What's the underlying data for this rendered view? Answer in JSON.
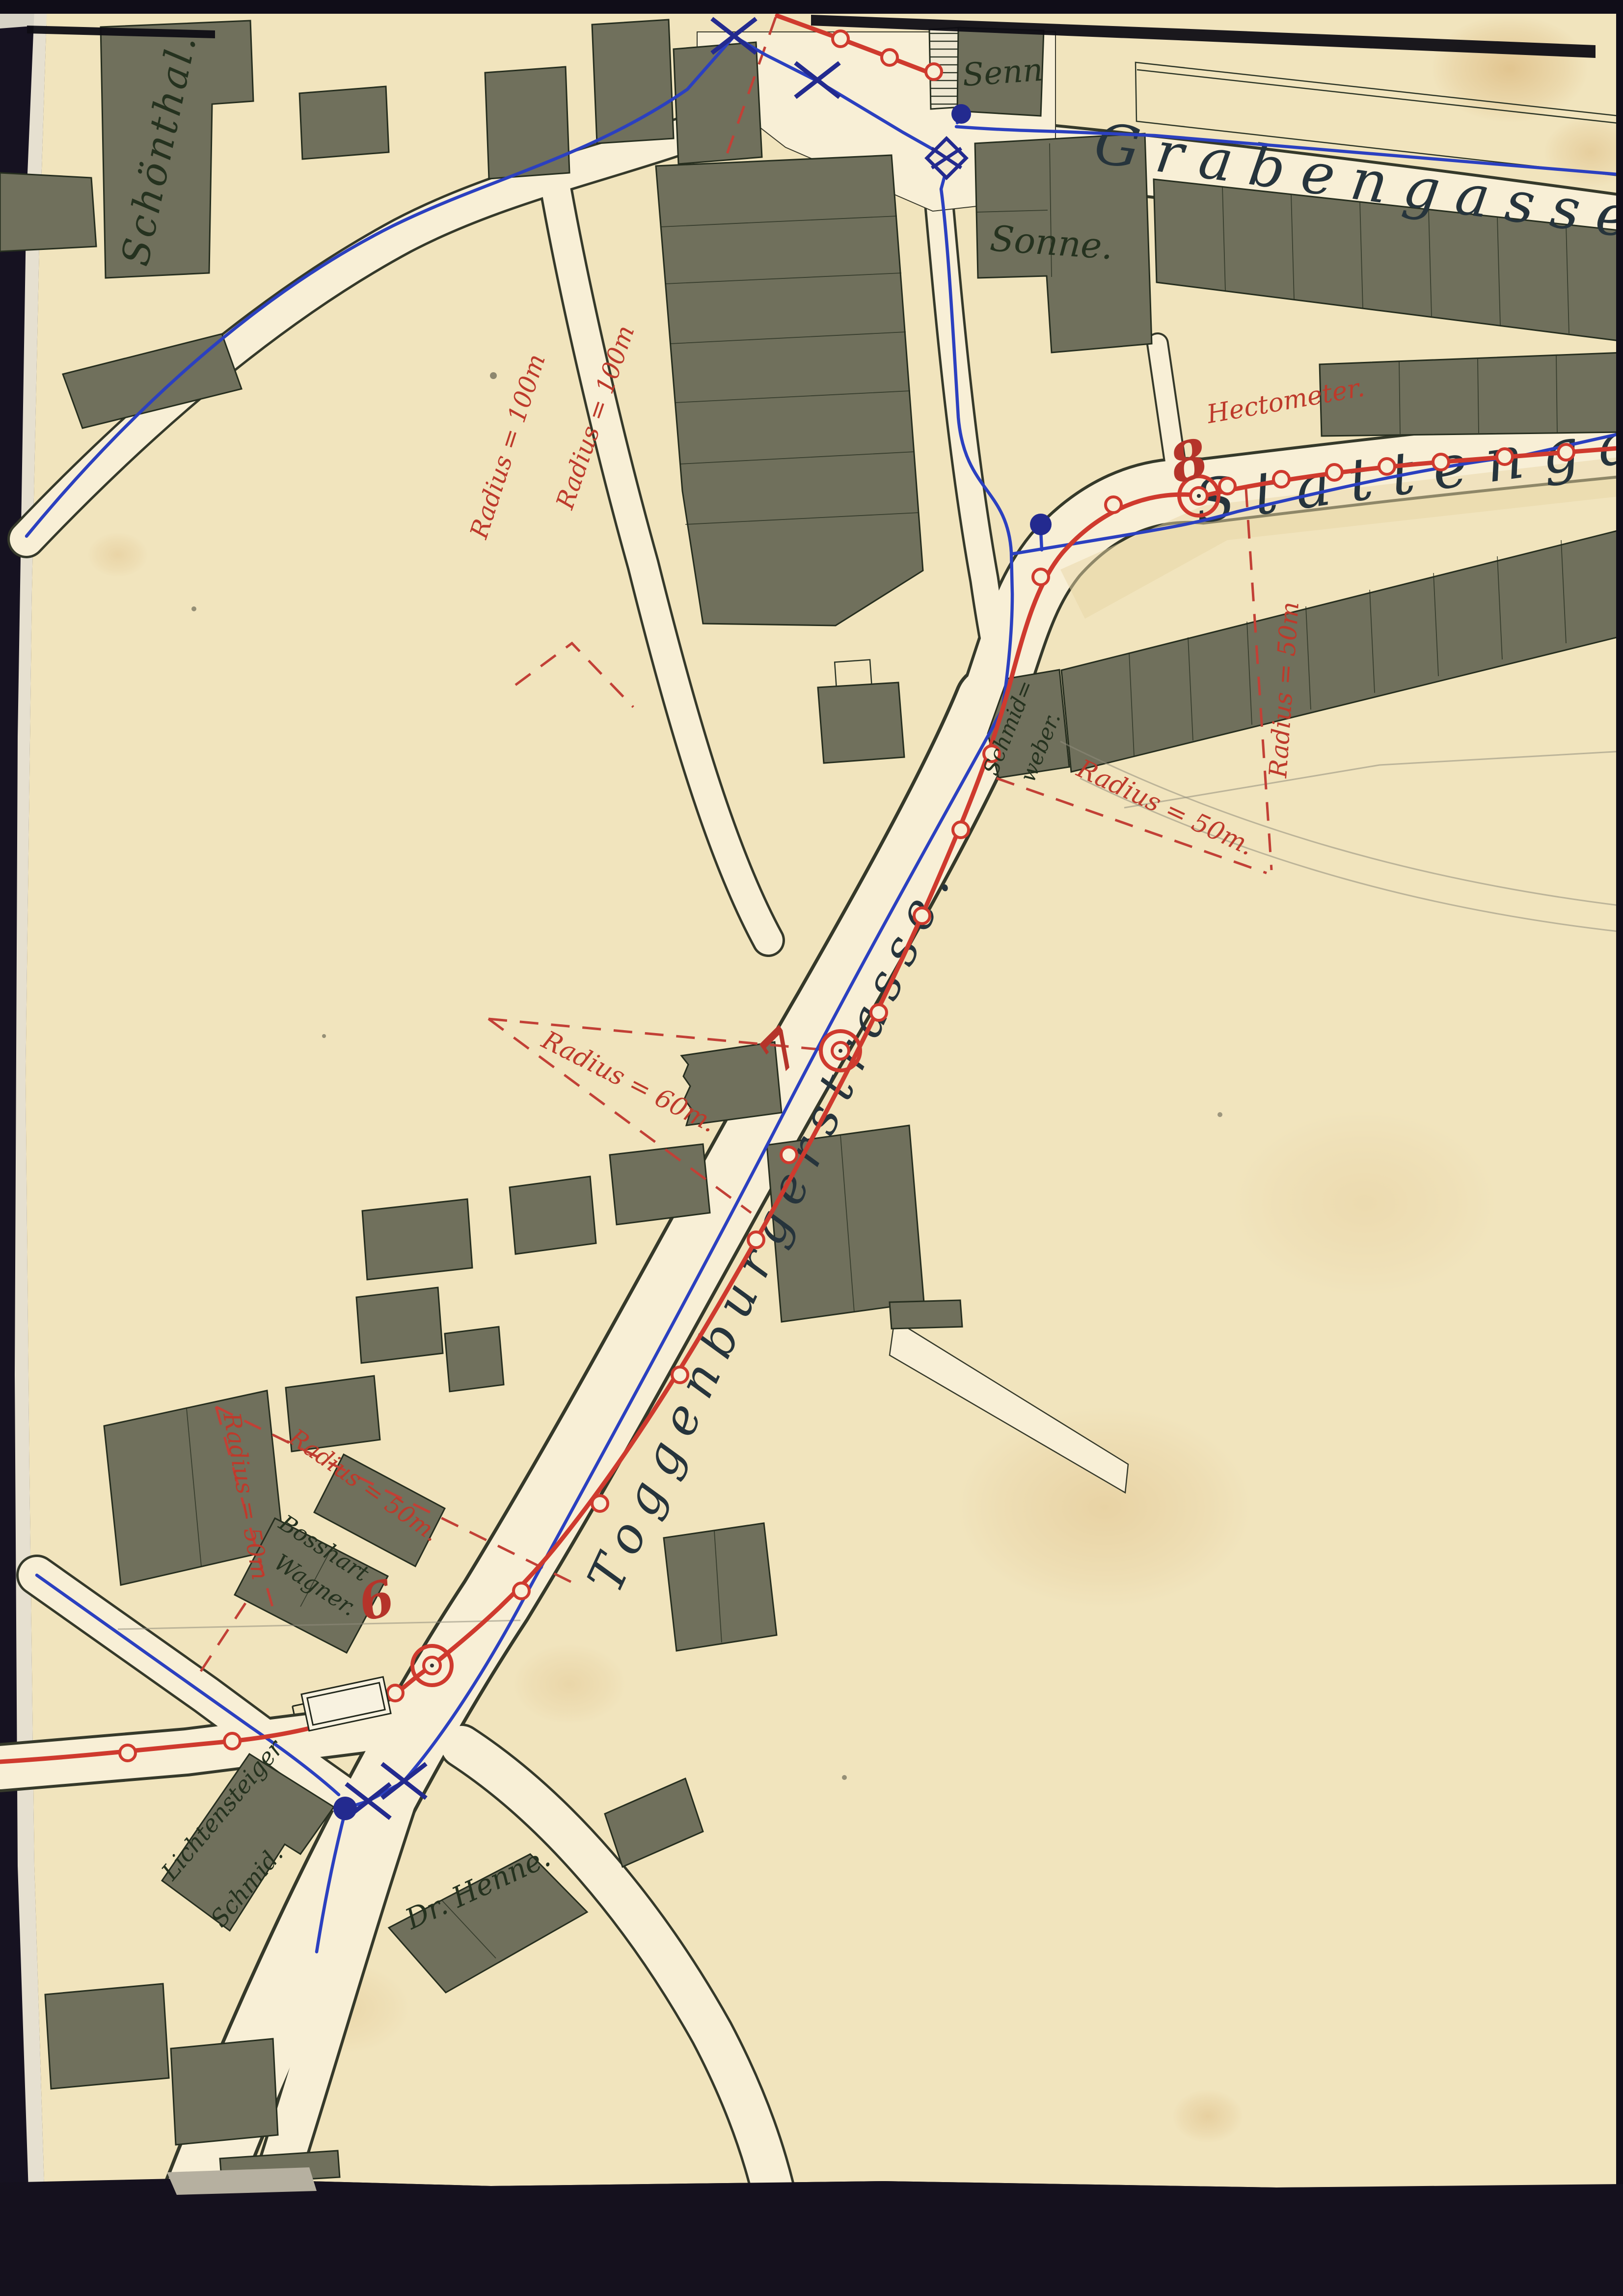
{
  "map": {
    "streets": {
      "grabengasse": "Grabengasse",
      "stattengasse": "Stattengasse",
      "toggenburgerstrasse": "Toggenburgerstrasse."
    },
    "places": {
      "schoenthal": "Schönthal.",
      "senn": "Senn",
      "sonne": "Sonne.",
      "schmid_weber_1": "Schmid=",
      "schmid_weber_2": "weber.",
      "bosshart": "Bosshart",
      "wagner": "Wagner.",
      "lichtensteiger": "Lichtensteiger",
      "lichtensteiger_2": "Schmid.",
      "dr_henne": "Dr. Henne."
    },
    "annotations": {
      "hectometer": "Hectometer.",
      "marker_8": "8",
      "marker_7": "7",
      "marker_6": "6",
      "radius_100_a": "Radius = 100m",
      "radius_100_b": "Radius = 100m",
      "radius_60": "Radius = 60m.",
      "radius_50_curve": "Radius = 50m.",
      "radius_50_vertical": "Radius = 50m",
      "radius_50_steep": "Radius = 50m",
      "radius_50_flat": "Radius = 50m."
    },
    "colors": {
      "paper": "#f1e4bd",
      "road": "#f8efd6",
      "building": "#70705c",
      "tram_red": "#cf3a2e",
      "water_blue": "#2b40c0",
      "annotation_red": "#bd3a2b",
      "ink": "#25321f",
      "border": "#161221"
    }
  }
}
